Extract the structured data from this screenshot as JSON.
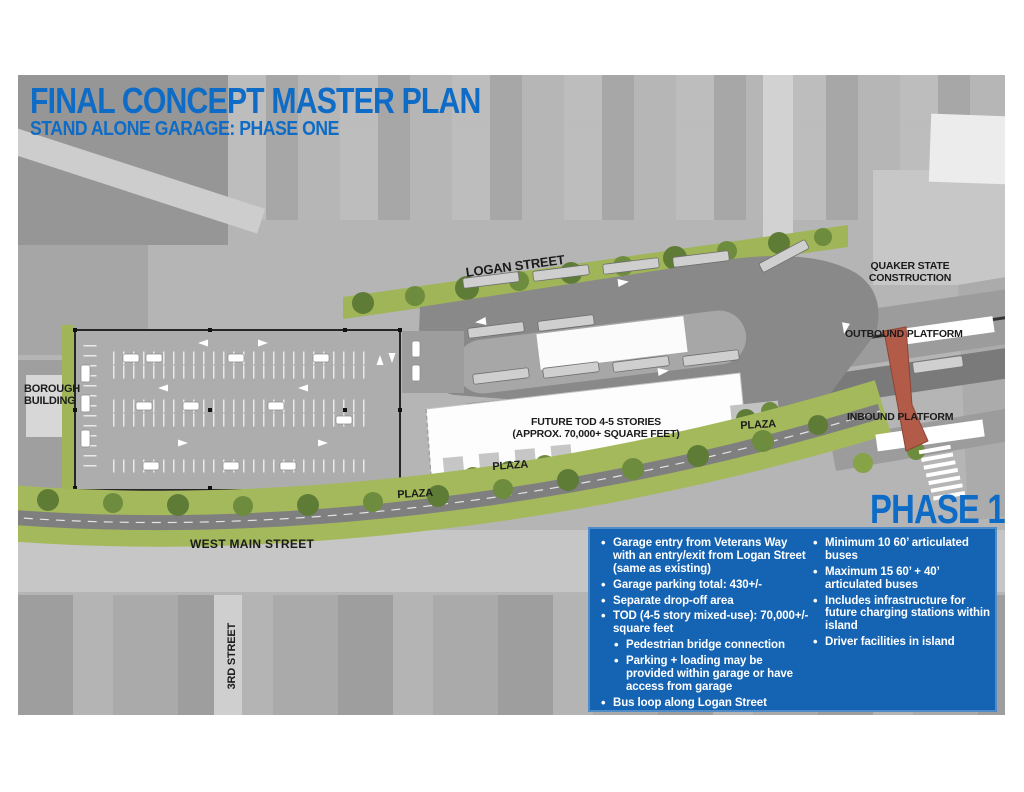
{
  "header": {
    "title": "FINAL CONCEPT MASTER PLAN",
    "subtitle": "STAND ALONE GARAGE: PHASE ONE"
  },
  "phase_label": "PHASE 1",
  "map_labels": {
    "logan_street": "LOGAN STREET",
    "quaker_state_line1": "QUAKER STATE",
    "quaker_state_line2": "CONSTRUCTION",
    "outbound_platform": "OUTBOUND PLATFORM",
    "inbound_platform": "INBOUND PLATFORM",
    "borough_line1": "BOROUGH",
    "borough_line2": "BUILDING",
    "west_main_street": "WEST MAIN STREET",
    "third_street": "3RD STREET",
    "plaza": "PLAZA",
    "tod_line1": "FUTURE TOD 4-5 STORIES",
    "tod_line2": "(APPROX. 70,000+ SQUARE FEET)"
  },
  "infobox": {
    "col1": [
      {
        "text": "Garage entry from Veterans Way with an entry/exit from Logan Street (same as existing)"
      },
      {
        "text": "Garage parking total: 430+/-"
      },
      {
        "text": "Separate drop-off area"
      },
      {
        "text": "TOD (4-5 story mixed-use): 70,000+/- square feet"
      },
      {
        "text": "Pedestrian bridge connection"
      },
      {
        "text": "Parking + loading may be provided within garage or have access from garage"
      },
      {
        "text": "Bus loop along Logan Street"
      }
    ],
    "col2": [
      {
        "text": "Minimum 10 60’ articulated buses"
      },
      {
        "text": "Maximum 15 60’ + 40’ articulated buses"
      },
      {
        "text": "Includes infrastructure for future charging stations within island"
      },
      {
        "text": "Driver facilities in island"
      }
    ]
  },
  "colors": {
    "title_blue": "#0f6cc6",
    "infobox_blue": "#1564b4",
    "landscape_green": "#9fb557",
    "tree_green": "#5e7c36",
    "pavement_gray": "#898989",
    "bridge_red": "#b35b49"
  }
}
